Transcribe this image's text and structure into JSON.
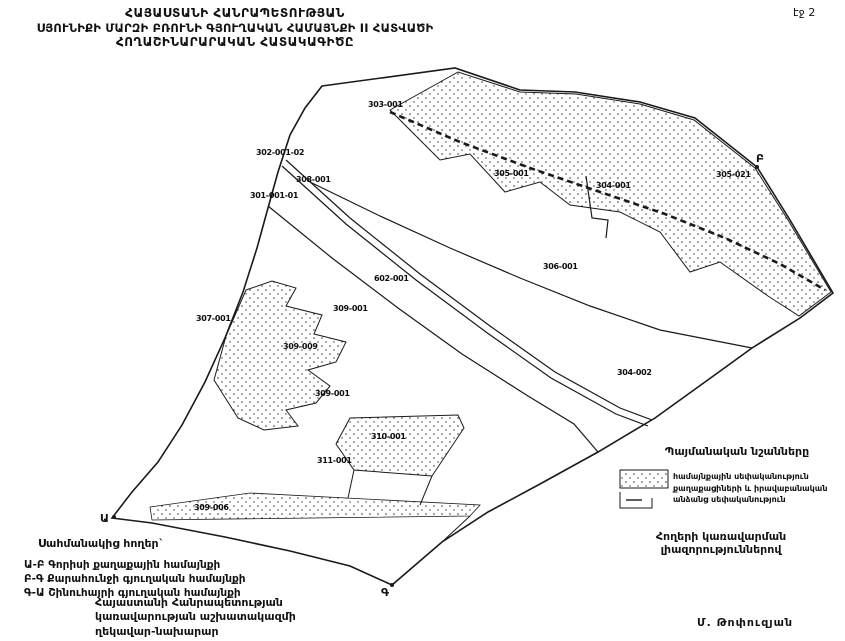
{
  "page": {
    "page_label": "էջ 2"
  },
  "title": {
    "line1": "ՀԱՅԱՍՏԱՆԻ ՀԱՆՐԱՊԵՏՈՒԹՅԱՆ",
    "line2": "ՍՅՈՒՆԻՔԻ ՄԱՐԶԻ ԲՌՈՒՆԻ ԳՅՈՒՂԱԿԱՆ ՀԱՄԱՅՆՔԻ  II ՀԱՏՎԱԾԻ",
    "line3": "ՀՈՂԱՇԻՆԱՐԱՐԱԿԱՆ ՀԱՏԱԿԱԳԻԾԸ"
  },
  "legend": {
    "title": "Պայմանական նշանները",
    "item_line1": "համայնքային սեփականություն",
    "item_line2": "քաղաքացիների և իրավաբանական",
    "item_line3": "անձանց սեփականություն",
    "swatch": "stipple-dot-pattern"
  },
  "notes": {
    "management": "Հողերի կառավարման լիազորություններով",
    "adjacent_title": "Սահմանակից հողեր`",
    "adjacent1": "Ա-Բ Գորիսի քաղաքային համայնքի",
    "adjacent2": "Բ-Գ Քարահունջի գյուղական համայնքի",
    "adjacent3": "Գ-Ա Շինուհայրի գյուղական համայնքի",
    "gov_line1": "Հայաստանի Հանրապետության",
    "gov_line2": "կառավարության աշխատակազմի",
    "gov_line3": "ղեկավար-նախարար",
    "signatory": "Մ. Թոփուզյան"
  },
  "map": {
    "colors": {
      "line": "#1a1a1a",
      "background": "#ffffff",
      "stipple_dot": "#333333"
    },
    "labels": [
      {
        "text": "303-001"
      },
      {
        "text": "302-001-02"
      },
      {
        "text": "308-001"
      },
      {
        "text": "301-001-01"
      },
      {
        "text": "305-001"
      },
      {
        "text": "304-001"
      },
      {
        "text": "305-021"
      },
      {
        "text": "306-001"
      },
      {
        "text": "602-001"
      },
      {
        "text": "309-001"
      },
      {
        "text": "307-001"
      },
      {
        "text": "309-009"
      },
      {
        "text": "309-001"
      },
      {
        "text": "310-001"
      },
      {
        "text": "311-001"
      },
      {
        "text": "309-006"
      },
      {
        "text": "304-002"
      }
    ],
    "points": [
      {
        "label": "Ա"
      },
      {
        "label": "Բ"
      },
      {
        "label": "Գ"
      }
    ]
  }
}
